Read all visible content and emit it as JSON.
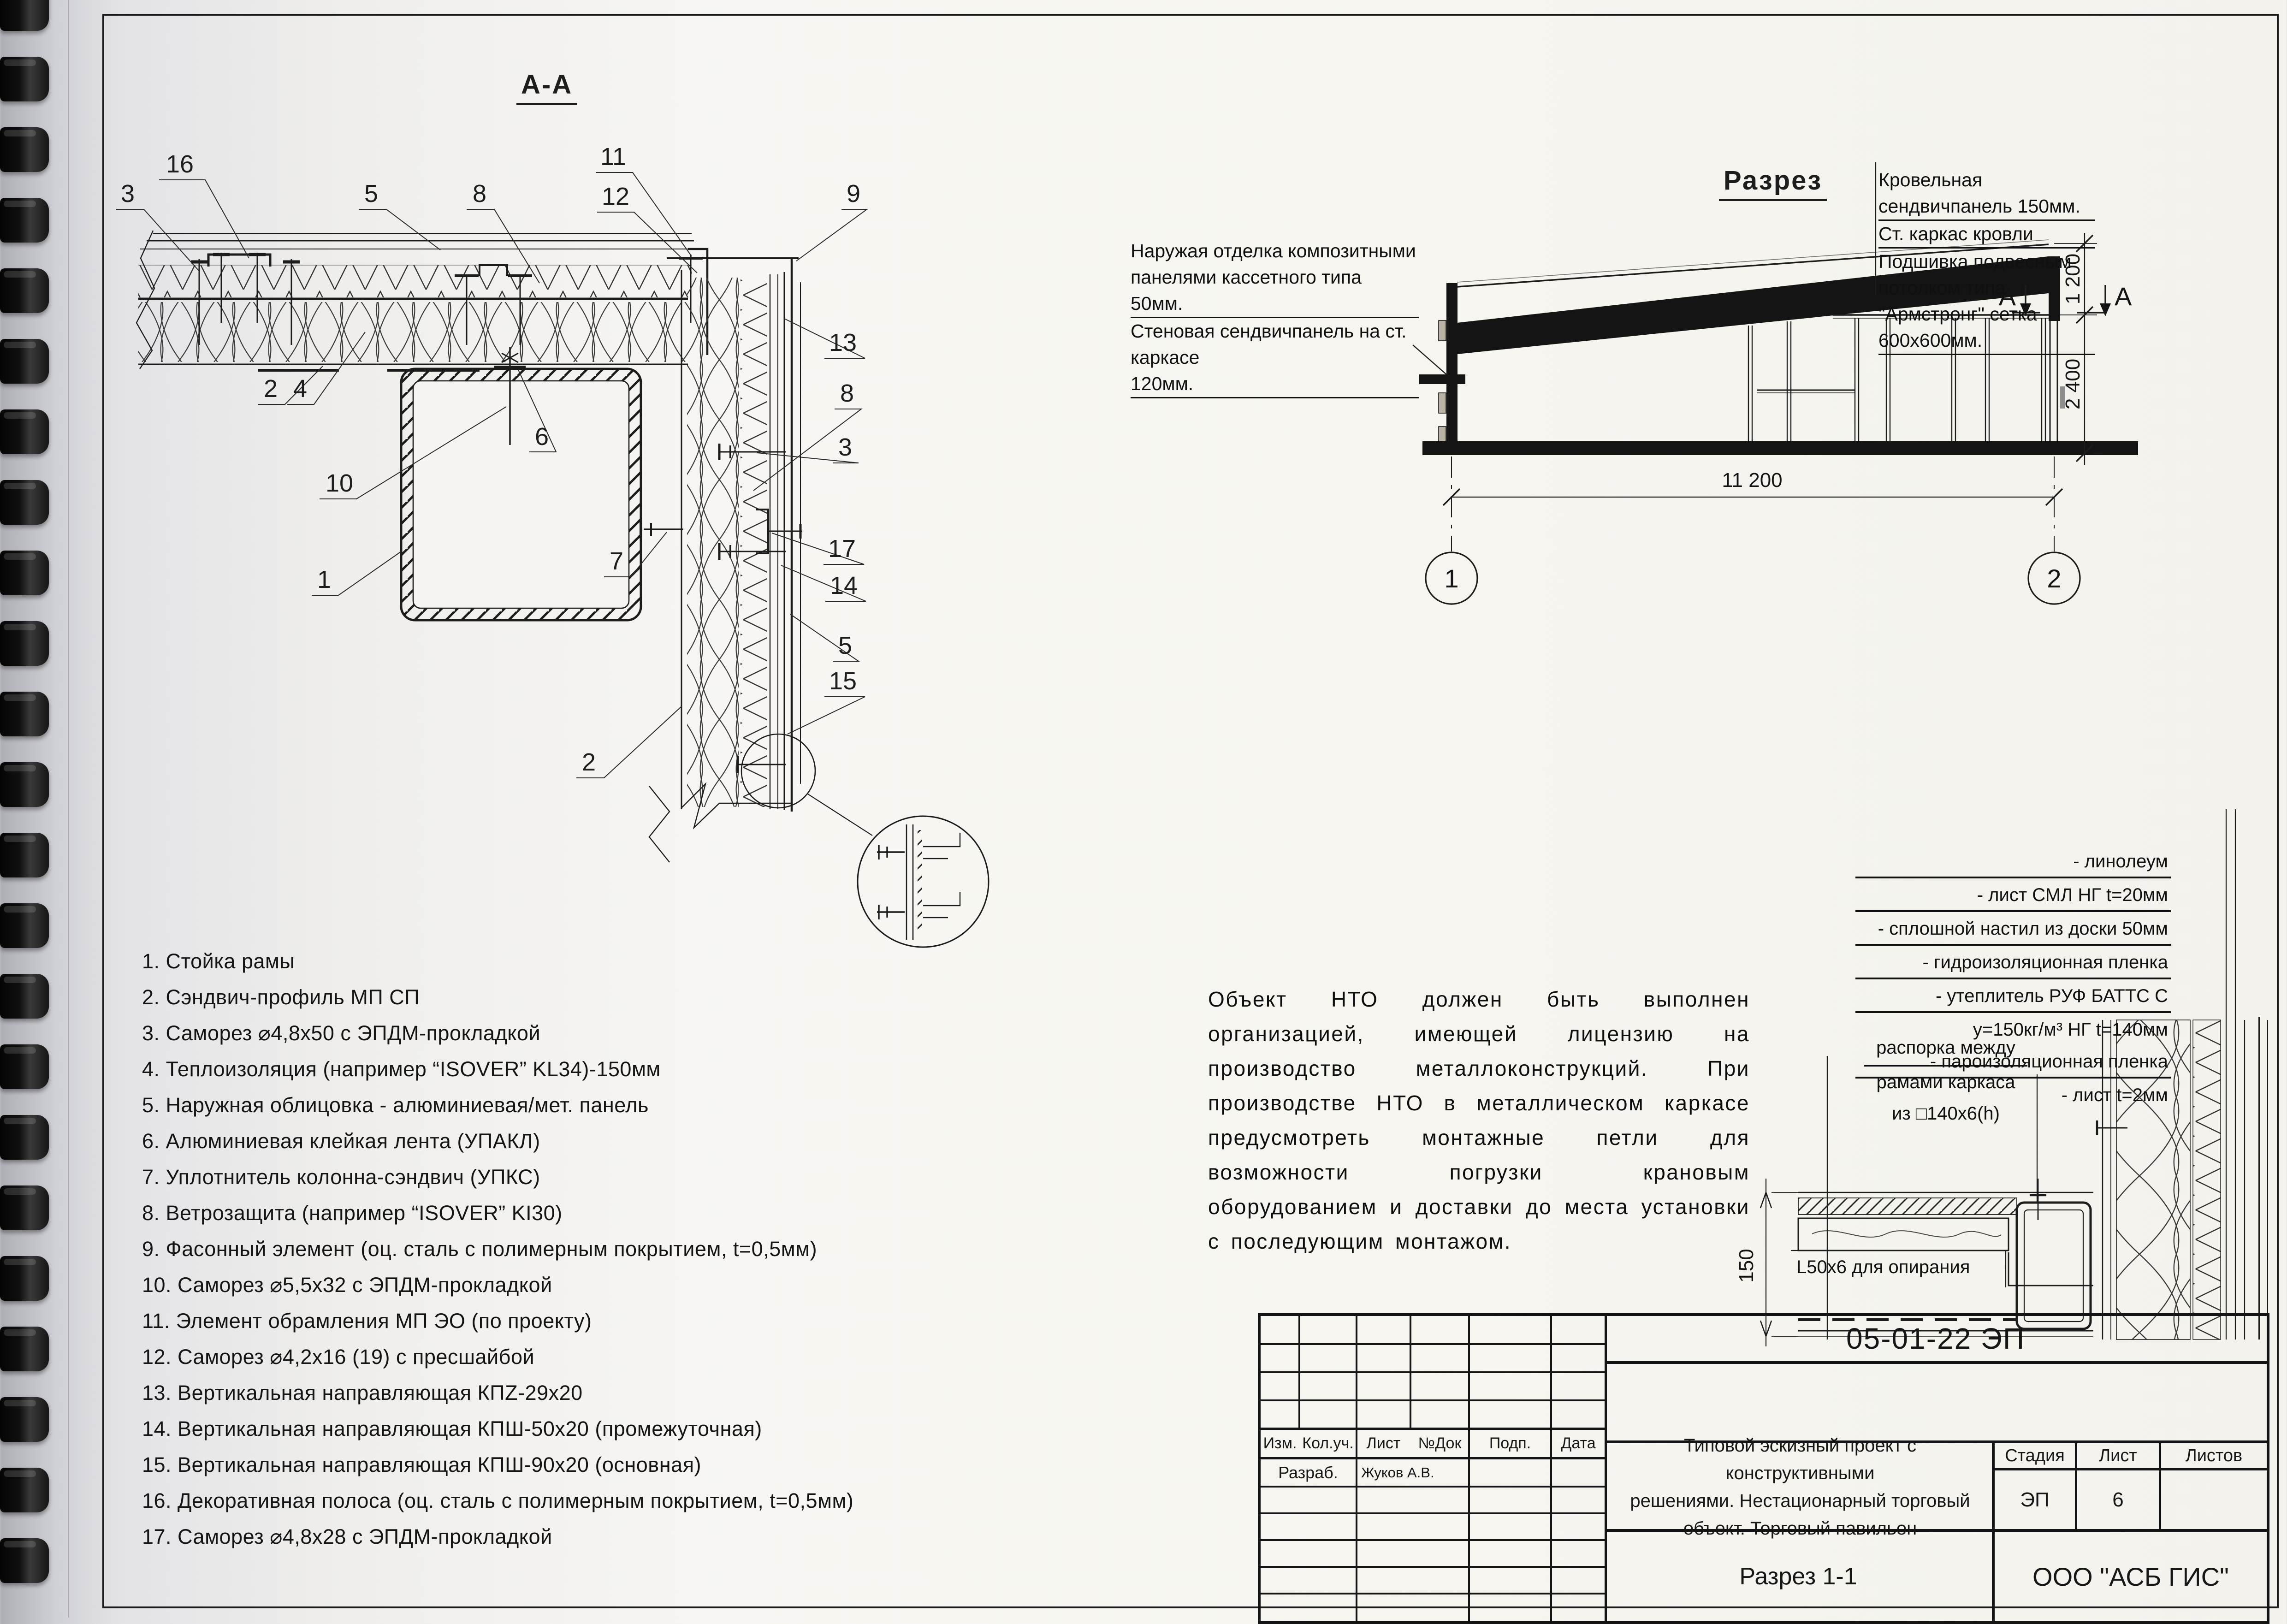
{
  "detail_aa": {
    "title": "А-А"
  },
  "section": {
    "title": "Разрез",
    "roof_note_lines": [
      "Кровельная сендвичпанель 150мм.",
      "Ст. каркас кровли",
      "Подшивка подвесным потолком типа",
      "\"Армстронг\" сетка 600х600мм."
    ],
    "wall_note_lines": [
      "Наружая отделка композитными",
      "панелями кассетного типа 50мм.",
      "Стеновая сендвичпанель на ст. каркасе",
      "120мм."
    ],
    "dim_roof": "1 200",
    "dim_wall": "2 400",
    "dim_width": "11 200",
    "axis_1": "1",
    "axis_2": "2",
    "section_marker": "А"
  },
  "callouts": {
    "c1": "1",
    "c2": "2",
    "c3": "3",
    "c4": "4",
    "c5": "5",
    "c6": "6",
    "c7": "7",
    "c8": "8",
    "c9": "9",
    "c10": "10",
    "c11": "11",
    "c12": "12",
    "c13": "13",
    "c14": "14",
    "c15": "15",
    "c16": "16",
    "c17": "17"
  },
  "legend": {
    "items": [
      "1. Стойка рамы",
      "2. Сэндвич-профиль МП СП",
      "3. Саморез ⌀4,8х50 с ЭПДМ-прокладкой",
      "4. Теплоизоляция (например “ISOVER” KL34)-150мм",
      "5. Наружная облицовка - алюминиевая/мет. панель",
      "6. Алюминиевая клейкая лента (УПАКЛ)",
      "7. Уплотнитель колонна-сэндвич (УПКС)",
      "8. Ветрозащита (например “ISOVER” KI30)",
      "9. Фасонный элемент (оц. сталь с полимерным покрытием, t=0,5мм)",
      "10. Саморез ⌀5,5х32 с ЭПДМ-прокладкой",
      "11. Элемент обрамления МП ЭО (по проекту)",
      "12. Саморез ⌀4,2х16 (19) с пресшайбой",
      "13. Вертикальная направляющая КПZ-29х20",
      "14. Вертикальная направляющая КПШ-50х20 (промежуточная)",
      "15. Вертикальная направляющая КПШ-90х20 (основная)",
      "16. Декоративная полоса (оц. сталь с полимерным покрытием, t=0,5мм)",
      "17. Саморез ⌀4,8х28 с ЭПДМ-прокладкой"
    ]
  },
  "notes": {
    "text": "Объект НТО должен быть выполнен организацией, имеющей лицензию на производство металлоконструкций. При производстве НТО в металлическом каркасе предусмотреть монтажные петли для возможности погрузки крановым оборудованием и доставки до места установки с последующим монтажом."
  },
  "floor_detail": {
    "layers": [
      "- линолеум",
      "- лист СМЛ НГ t=20мм",
      "- сплошной настил из доски 50мм",
      "- гидроизоляционная пленка",
      "- утеплитель РУФ БАТТС С",
      "у=150кг/м³ НГ t=140мм",
      "- пароизоляционная пленка",
      "- лист t=2мм"
    ],
    "spacer_note_lines": [
      "распорка между",
      "рамами каркаса",
      "из □140х6(h)"
    ],
    "support_note": "L50х6 для опирания",
    "dim_150": "150"
  },
  "title_block": {
    "doc_code": "05-01-22 ЭП",
    "cols": [
      "Изм.",
      "Кол.уч.",
      "Лист",
      "№Док",
      "Подп.",
      "Дата"
    ],
    "developer_label": "Разраб.",
    "developer_name": "Жуков А.В.",
    "project_lines": [
      "Типовой эскизный проект с конструктивными",
      "решениями. Нестационарный торговый",
      "объект. Торговый павильон"
    ],
    "stage_label": "Стадия",
    "sheet_label": "Лист",
    "sheets_label": "Листов",
    "stage_value": "ЭП",
    "sheet_value": "6",
    "sheets_value": "",
    "drawing_name": "Разрез 1-1",
    "company": "ООО \"АСБ ГИС\""
  }
}
